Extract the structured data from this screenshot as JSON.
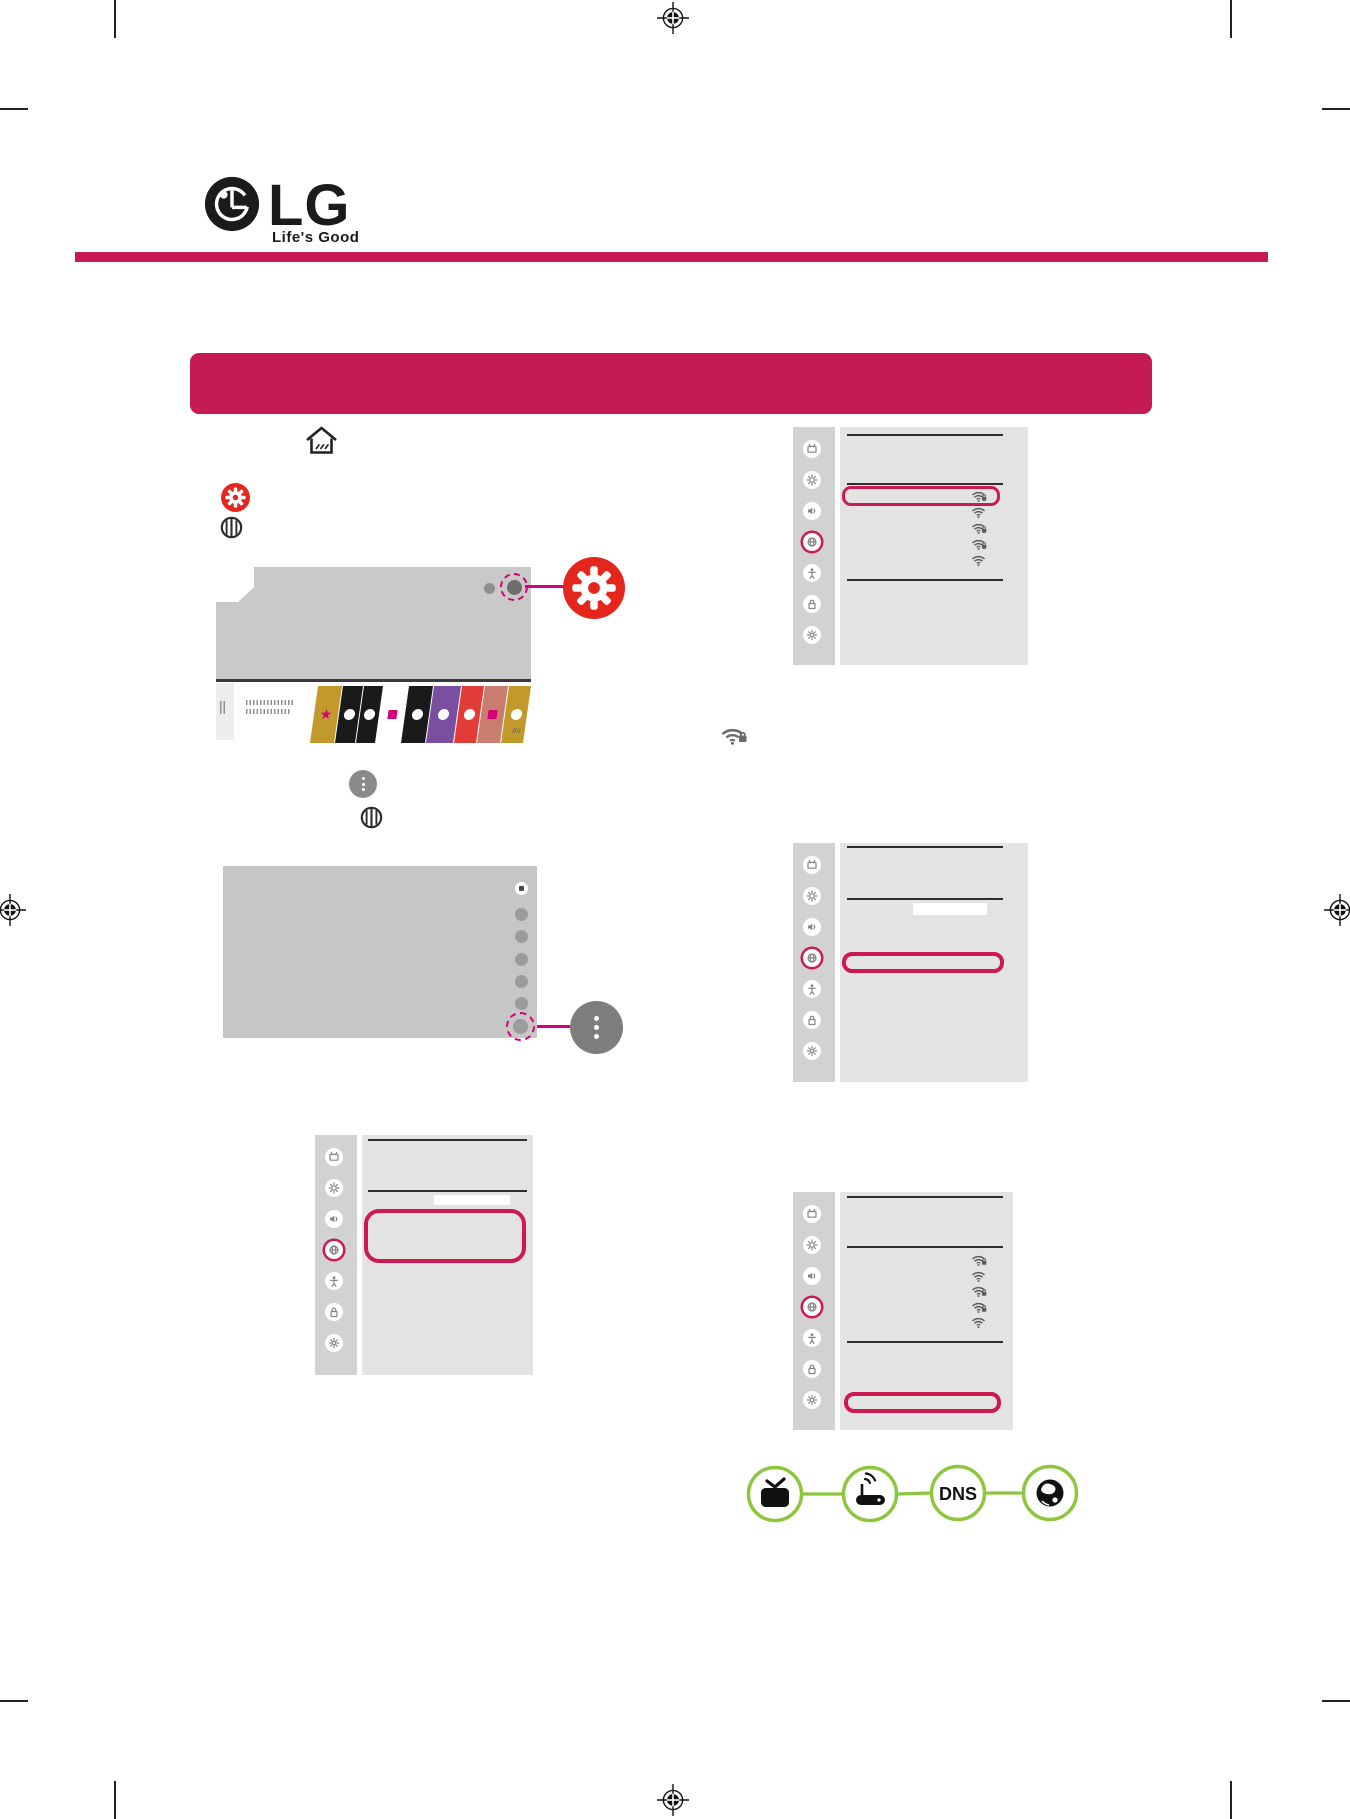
{
  "page": {
    "background": "#ffffff",
    "title_bar_text": ""
  },
  "brand": {
    "logo_text": "LG",
    "tagline": "Life's Good"
  },
  "colors": {
    "brand_crimson": "#c51a52",
    "highlight_magenta": "#cd1852",
    "accent_magenta": "#d5007a",
    "red_button": "#e5261d",
    "panel_main": "#e3e3e3",
    "panel_sidebar": "#d2d2d2",
    "screen_gray": "#c9c9c9",
    "line_dark": "#2e2e2e",
    "callout_gray": "#7d7d7d",
    "diagram_green": "#8dc63f"
  },
  "remote_icons": [
    {
      "name": "home-icon"
    },
    {
      "name": "settings-gear-icon"
    },
    {
      "name": "scroll-wheel-icon"
    },
    {
      "name": "more-options-icon"
    }
  ],
  "settings_sidebar": {
    "icons": [
      "channels-icon",
      "picture-icon",
      "sound-icon",
      "network-icon",
      "accessibility-icon",
      "lock-icon",
      "general-icon"
    ],
    "selected_index": 3
  },
  "settings_panels": [
    {
      "name": "wifi-connection-list",
      "highlight": "first-wifi-row",
      "wifi_rows": [
        {
          "secured": true,
          "highlighted": true
        },
        {
          "secured": false
        },
        {
          "secured": true
        },
        {
          "secured": true
        },
        {
          "secured": false
        }
      ]
    },
    {
      "name": "network-menu-row-highlight",
      "has_button": true,
      "highlight": "menu-row",
      "wifi_rows": []
    },
    {
      "name": "network-menu-block-highlight",
      "has_button": true,
      "highlight": "menu-block",
      "wifi_rows": []
    },
    {
      "name": "wifi-list-bottom-highlight",
      "highlight": "bottom-row",
      "wifi_rows": [
        {
          "secured": true
        },
        {
          "secured": false
        },
        {
          "secured": true
        },
        {
          "secured": true
        },
        {
          "secured": false
        }
      ]
    }
  ],
  "launcher": {
    "av_label": "AV",
    "tiles": [
      {
        "color": "#c2992b",
        "glyph": "star",
        "width": 24
      },
      {
        "color": "#1a1a1a",
        "glyph": "dot",
        "width": 20
      },
      {
        "color": "#1a1a1a",
        "glyph": "dot",
        "width": 19
      },
      {
        "color": "#ffffff",
        "glyph": "square",
        "width": 24
      },
      {
        "color": "#1a1a1a",
        "glyph": "dot",
        "width": 24
      },
      {
        "color": "#7a4fa0",
        "glyph": "dot",
        "width": 27
      },
      {
        "color": "#e23c36",
        "glyph": "dot",
        "width": 22
      },
      {
        "color": "#c87d6f",
        "glyph": "square",
        "width": 23
      },
      {
        "color": "#c2992b",
        "glyph": "dot",
        "width": 22
      }
    ]
  },
  "diagram": {
    "dns_label": "DNS",
    "nodes": [
      {
        "name": "tv-node",
        "icon": "tv-icon"
      },
      {
        "name": "router-node",
        "icon": "wireless-router-icon"
      },
      {
        "name": "dns-node",
        "icon": "dns-label"
      },
      {
        "name": "internet-node",
        "icon": "globe-icon"
      }
    ]
  }
}
